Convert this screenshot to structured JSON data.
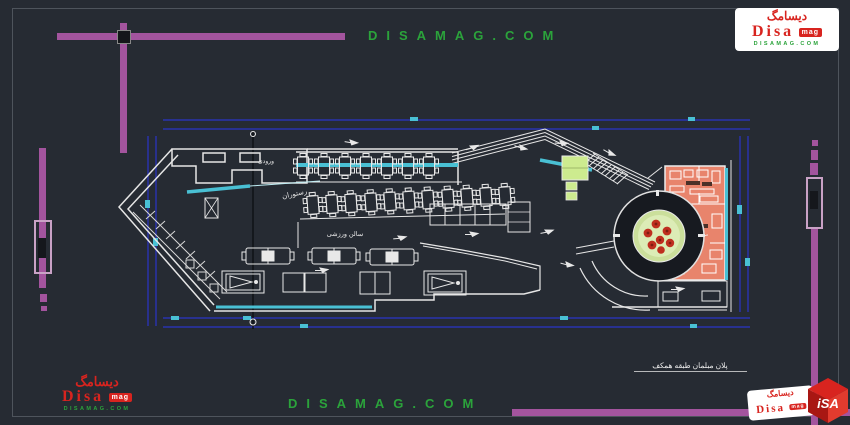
{
  "watermarks": {
    "top": "DISAMAG.COM",
    "bottom": "DISAMAG.COM"
  },
  "logo": {
    "persian": "دیسامگ",
    "name": "Disa",
    "badge": "mag",
    "site": "DISAMAG.COM",
    "cube": "iSA"
  },
  "plan": {
    "labels": {
      "entry": "ورودی",
      "restaurant": "رستوران",
      "sports_hall": "سالن ورزشی"
    },
    "title": "پلان مبلمان طبقه همکف"
  },
  "colors": {
    "background": "#262b33",
    "frame_gray": "#4e545c",
    "purple": "#a3549e",
    "purple_light": "#c9a2c6",
    "dimension_blue": "#2a35c8",
    "glass_cyan": "#49c0d4",
    "wall_white": "#e8e8e8",
    "kitchen_orange": "#e8846c",
    "room_green": "#cdeb8f",
    "planter_green": "#cbdf9b",
    "flower_red": "#bf2e1f",
    "logo_red": "#d8241f",
    "watermark_green": "#2ba33b"
  }
}
